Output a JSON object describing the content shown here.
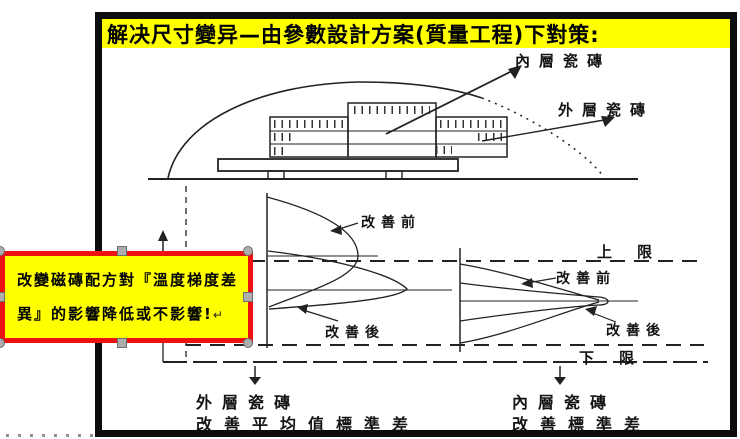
{
  "slide": {
    "title": "解决尺寸變异—由參數設計方案(質量工程)下對策:",
    "kiln": {
      "inner_tile_label": "內層瓷磚",
      "outer_tile_label": "外層瓷磚"
    },
    "distribution": {
      "upper_limit_label": "上　限",
      "lower_limit_label": "下　限",
      "left_before_label": "改善前",
      "left_after_label": "改善後",
      "right_before_label": "改善前",
      "right_after_label": "改善後"
    },
    "conclusions": {
      "left_title": "外層瓷磚",
      "left_desc": "改善平均值標準差",
      "right_title": "內層瓷磚",
      "right_desc": "改善標準差"
    }
  },
  "callout": {
    "line1": "改變磁磚配方對『溫度梯度差",
    "line2": "異』的影響降低或不影響!",
    "return_mark": "↵",
    "fill_color": "#FFFF00",
    "border_color": "#EE1111"
  },
  "colors": {
    "title_background": "#FFFF00",
    "ink": "#222222",
    "slide_border": "#0d0d0d",
    "handle_gray": "#adadad"
  }
}
